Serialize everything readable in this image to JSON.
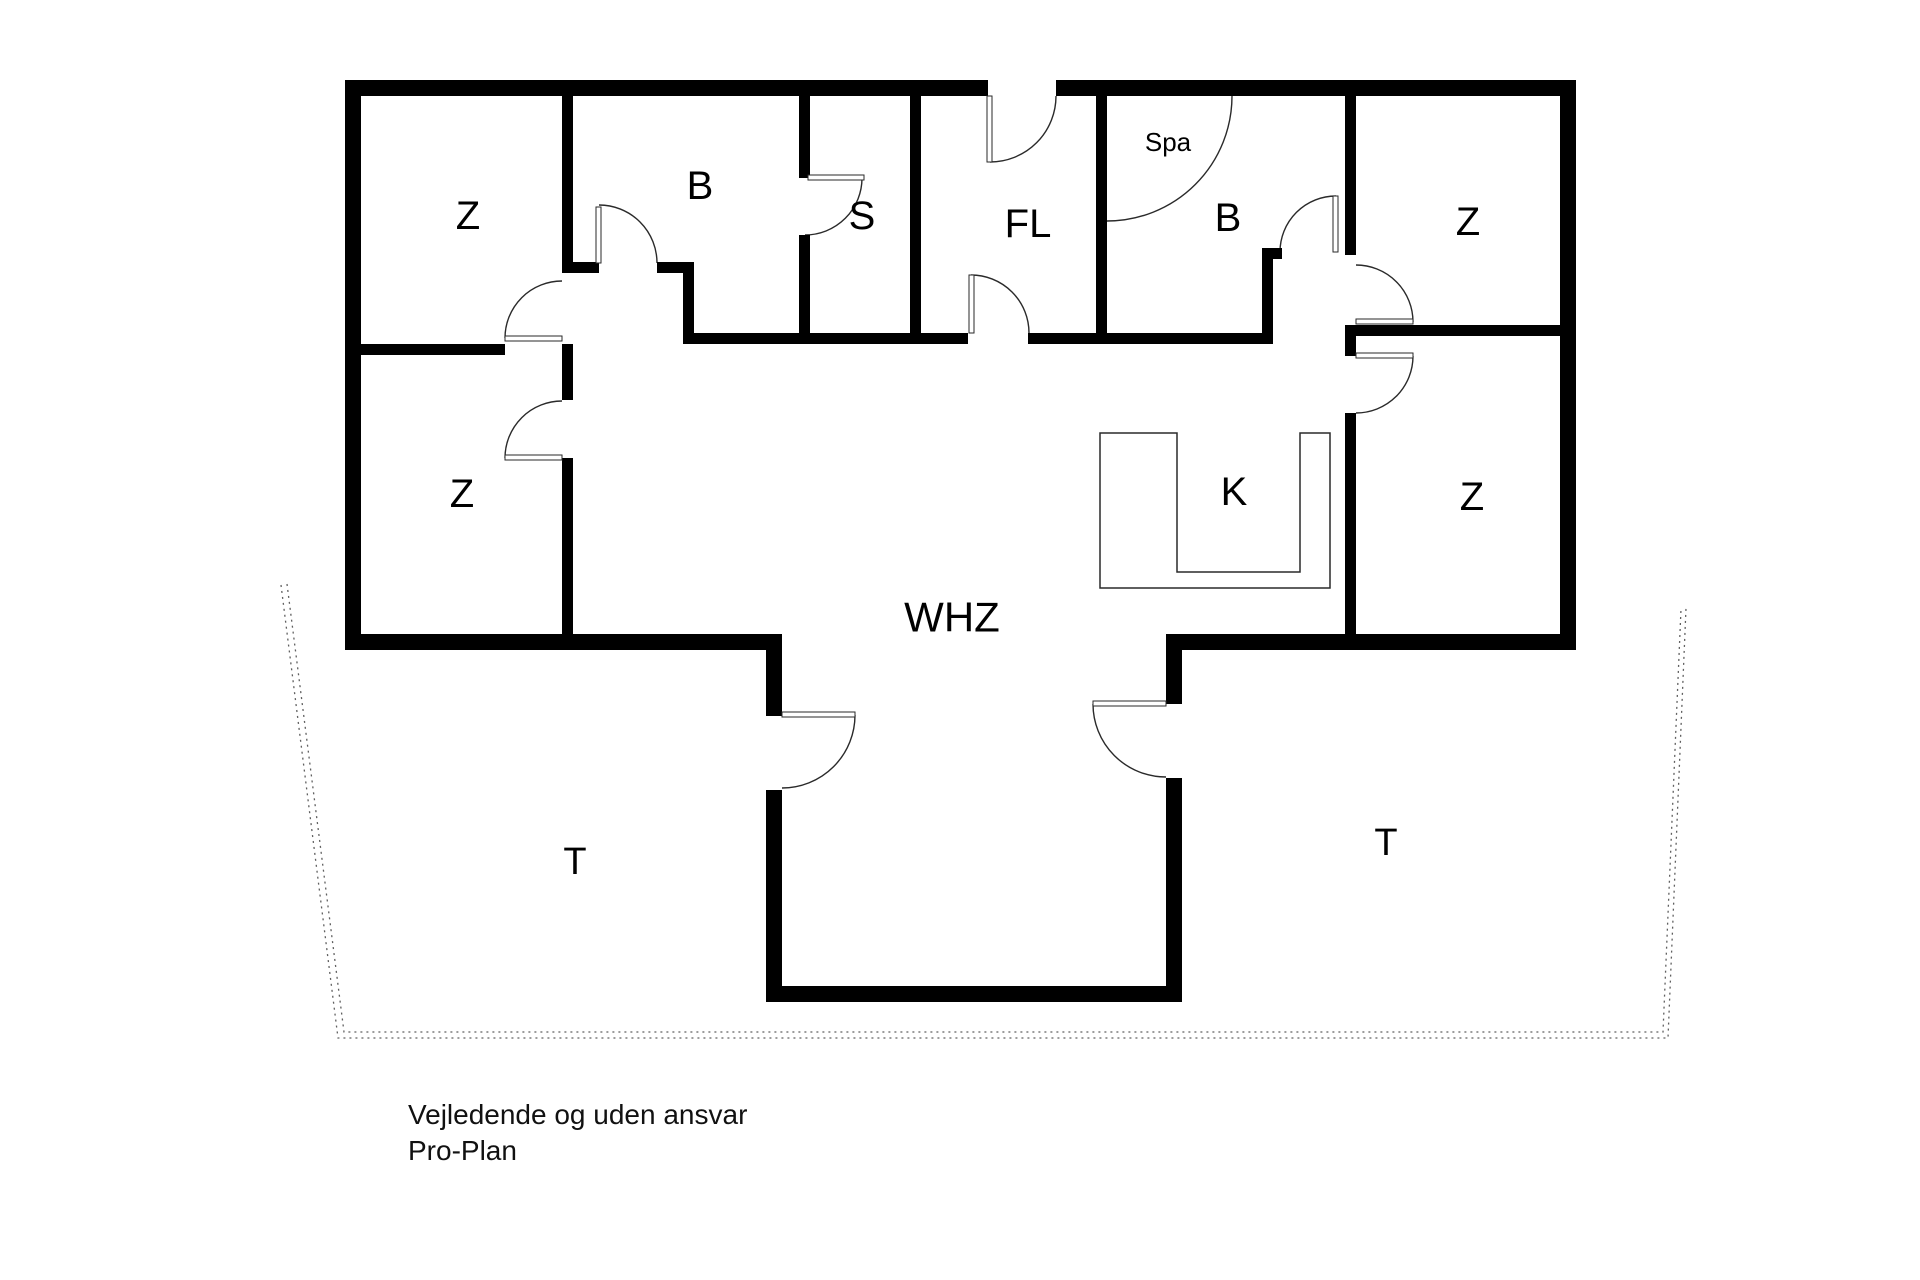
{
  "page": {
    "background": "#ffffff",
    "width": 1920,
    "height": 1280
  },
  "colors": {
    "wall": "#000000",
    "thin_line": "#2a2a2a",
    "dashed": "#606060",
    "text": "#000000"
  },
  "floorplan": {
    "walls": [
      {
        "name": "exterior-wall-top-left",
        "r": [
          345,
          80,
          643,
          16
        ]
      },
      {
        "name": "exterior-wall-top-right",
        "r": [
          1056,
          80,
          520,
          16
        ]
      },
      {
        "name": "exterior-wall-left",
        "r": [
          345,
          80,
          16,
          570
        ]
      },
      {
        "name": "exterior-wall-right",
        "r": [
          1560,
          80,
          16,
          570
        ]
      },
      {
        "name": "exterior-wall-bottom-left",
        "r": [
          345,
          634,
          437,
          16
        ]
      },
      {
        "name": "exterior-wall-bottom-right",
        "r": [
          1166,
          634,
          410,
          16
        ]
      },
      {
        "name": "living-bay-wall-left-upper",
        "r": [
          766,
          634,
          16,
          82
        ]
      },
      {
        "name": "living-bay-wall-left-lower",
        "r": [
          766,
          790,
          16,
          212
        ]
      },
      {
        "name": "living-bay-wall-right-upper",
        "r": [
          1166,
          634,
          16,
          70
        ]
      },
      {
        "name": "living-bay-wall-right-lower",
        "r": [
          1166,
          778,
          16,
          224
        ]
      },
      {
        "name": "living-bay-wall-bottom",
        "r": [
          766,
          986,
          416,
          16
        ]
      },
      {
        "name": "wall-z1-b",
        "r": [
          562,
          96,
          11,
          176
        ]
      },
      {
        "name": "wall-b-bottom-left-stub",
        "r": [
          562,
          262,
          37,
          11
        ]
      },
      {
        "name": "wall-b-bottom-right-stub",
        "r": [
          657,
          262,
          37,
          11
        ]
      },
      {
        "name": "wall-b-step",
        "r": [
          683,
          262,
          11,
          82
        ]
      },
      {
        "name": "wall-hall-top",
        "r": [
          683,
          333,
          238,
          11
        ]
      },
      {
        "name": "wall-b-s-upper",
        "r": [
          799,
          96,
          11,
          82
        ]
      },
      {
        "name": "wall-b-s-lower",
        "r": [
          799,
          235,
          11,
          109
        ]
      },
      {
        "name": "wall-s-fl",
        "r": [
          910,
          96,
          11,
          248
        ]
      },
      {
        "name": "wall-fl-bottom-left",
        "r": [
          921,
          333,
          47,
          11
        ]
      },
      {
        "name": "wall-fl-bottom-right",
        "r": [
          1028,
          333,
          79,
          11
        ]
      },
      {
        "name": "wall-fl-bspa",
        "r": [
          1096,
          96,
          11,
          248
        ]
      },
      {
        "name": "wall-bspa-bottom",
        "r": [
          1107,
          333,
          166,
          11
        ]
      },
      {
        "name": "wall-bspa-step",
        "r": [
          1262,
          248,
          11,
          96
        ]
      },
      {
        "name": "wall-bspa-stub",
        "r": [
          1262,
          248,
          20,
          11
        ]
      },
      {
        "name": "wall-bspa-z2",
        "r": [
          1345,
          96,
          11,
          159
        ]
      },
      {
        "name": "wall-z2-z4-divider",
        "r": [
          1345,
          325,
          215,
          11
        ]
      },
      {
        "name": "wall-z4-stub",
        "r": [
          1345,
          336,
          11,
          20
        ]
      },
      {
        "name": "wall-z4-left",
        "r": [
          1345,
          413,
          11,
          237
        ]
      },
      {
        "name": "wall-z1-z3-divider",
        "r": [
          361,
          344,
          144,
          11
        ]
      },
      {
        "name": "wall-z3-right-upper",
        "r": [
          562,
          344,
          11,
          56
        ]
      },
      {
        "name": "wall-z3-right-lower",
        "r": [
          562,
          458,
          11,
          192
        ]
      }
    ],
    "door_leaves": [
      {
        "name": "door-leaf-entry",
        "r": [
          987,
          96,
          5,
          66
        ]
      },
      {
        "name": "door-leaf-bath",
        "r": [
          596,
          207,
          5,
          56
        ]
      },
      {
        "name": "door-leaf-sauna",
        "r": [
          808,
          175,
          56,
          5
        ]
      },
      {
        "name": "door-leaf-hallway",
        "r": [
          969,
          275,
          5,
          58
        ]
      },
      {
        "name": "door-leaf-spa-bath",
        "r": [
          1333,
          196,
          5,
          56
        ]
      },
      {
        "name": "door-leaf-z-top-right",
        "r": [
          1356,
          319,
          57,
          5
        ]
      },
      {
        "name": "door-leaf-z-bottom-right",
        "r": [
          1356,
          353,
          57,
          5
        ]
      },
      {
        "name": "door-leaf-z-top-left",
        "r": [
          505,
          336,
          57,
          5
        ]
      },
      {
        "name": "door-leaf-z-bottom-left",
        "r": [
          505,
          455,
          57,
          5
        ]
      },
      {
        "name": "door-leaf-terrace-left",
        "r": [
          782,
          712,
          73,
          5
        ]
      },
      {
        "name": "door-leaf-terrace-right",
        "r": [
          1093,
          701,
          73,
          5
        ]
      }
    ],
    "door_arcs": [
      {
        "name": "door-arc-entry",
        "cx": 990,
        "cy": 96,
        "r": 66,
        "a0": 90,
        "a1": 0
      },
      {
        "name": "door-arc-bath",
        "cx": 599,
        "cy": 263,
        "r": 58,
        "a0": 270,
        "a1": 0
      },
      {
        "name": "door-arc-sauna",
        "cx": 805,
        "cy": 178,
        "r": 57,
        "a0": 0,
        "a1": 90
      },
      {
        "name": "door-arc-hallway",
        "cx": 971,
        "cy": 333,
        "r": 58,
        "a0": 270,
        "a1": 0
      },
      {
        "name": "door-arc-spa-bath",
        "cx": 1336,
        "cy": 252,
        "r": 56,
        "a0": 270,
        "a1": 180
      },
      {
        "name": "door-arc-z-top-right",
        "cx": 1356,
        "cy": 322,
        "r": 57,
        "a0": 0,
        "a1": 270
      },
      {
        "name": "door-arc-z-bottom-right",
        "cx": 1356,
        "cy": 356,
        "r": 57,
        "a0": 0,
        "a1": 90
      },
      {
        "name": "door-arc-z-top-left",
        "cx": 562,
        "cy": 338,
        "r": 57,
        "a0": 180,
        "a1": 270
      },
      {
        "name": "door-arc-z-bottom-left",
        "cx": 562,
        "cy": 458,
        "r": 57,
        "a0": 180,
        "a1": 270
      },
      {
        "name": "door-arc-terrace-left",
        "cx": 782,
        "cy": 715,
        "r": 73,
        "a0": 0,
        "a1": 90
      },
      {
        "name": "door-arc-terrace-right",
        "cx": 1166,
        "cy": 704,
        "r": 73,
        "a0": 180,
        "a1": 90
      },
      {
        "name": "spa-corner-tub-arc",
        "cx": 1107,
        "cy": 96,
        "r": 125,
        "a0": 0,
        "a1": 90
      }
    ],
    "kitchen_counter": {
      "name": "kitchen-counter-outline",
      "path": "M1100,433 L1177,433 L1177,572 L1300,572 L1300,433 L1330,433 L1330,588 L1100,588 Z"
    },
    "terrace_boundary": [
      {
        "name": "terrace-dashed-line-outer",
        "path": "M281,585 L338,1038 L1668,1038 L1686,608"
      },
      {
        "name": "terrace-dashed-line-inner",
        "path": "M287,584 L344,1032 L1663,1032 L1681,609"
      }
    ],
    "room_labels": [
      {
        "name": "room-label-z-top-left",
        "text": "Z",
        "x": 468,
        "y": 216,
        "size": 40
      },
      {
        "name": "room-label-b-bath",
        "text": "B",
        "x": 700,
        "y": 186,
        "size": 40
      },
      {
        "name": "room-label-s-sauna",
        "text": "S",
        "x": 862,
        "y": 216,
        "size": 40
      },
      {
        "name": "room-label-fl-hallway",
        "text": "FL",
        "x": 1028,
        "y": 224,
        "size": 40
      },
      {
        "name": "room-label-spa",
        "text": "Spa",
        "x": 1168,
        "y": 142,
        "size": 26
      },
      {
        "name": "room-label-b-spa-bath",
        "text": "B",
        "x": 1228,
        "y": 218,
        "size": 40
      },
      {
        "name": "room-label-z-top-right",
        "text": "Z",
        "x": 1468,
        "y": 222,
        "size": 40
      },
      {
        "name": "room-label-z-bottom-left",
        "text": "Z",
        "x": 462,
        "y": 494,
        "size": 40
      },
      {
        "name": "room-label-k-kitchen",
        "text": "K",
        "x": 1234,
        "y": 492,
        "size": 40
      },
      {
        "name": "room-label-z-bottom-right",
        "text": "Z",
        "x": 1472,
        "y": 497,
        "size": 40
      },
      {
        "name": "room-label-whz-living",
        "text": "WHZ",
        "x": 952,
        "y": 617,
        "size": 42
      },
      {
        "name": "room-label-t-terrace-left",
        "text": "T",
        "x": 575,
        "y": 862,
        "size": 38
      },
      {
        "name": "room-label-t-terrace-right",
        "text": "T",
        "x": 1386,
        "y": 843,
        "size": 38
      }
    ],
    "disclaimer": {
      "line1": "Vejledende og uden ansvar",
      "line2": "Pro-Plan"
    }
  }
}
